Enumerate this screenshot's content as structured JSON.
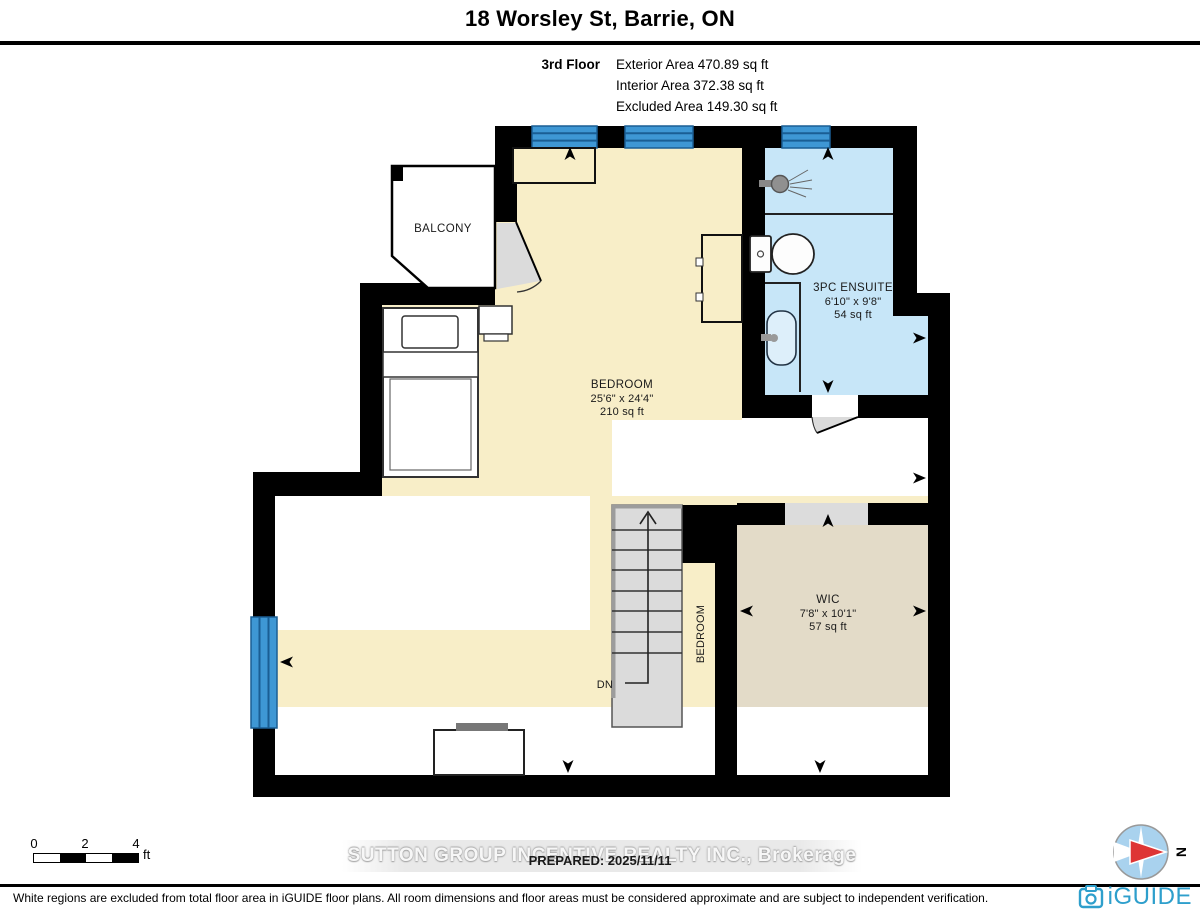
{
  "header": {
    "title": "18 Worsley St, Barrie, ON",
    "floor_label": "3rd Floor",
    "stats": [
      "Exterior Area 470.89 sq ft",
      "Interior Area 372.38 sq ft",
      "Excluded Area 149.30 sq ft"
    ]
  },
  "rooms": {
    "balcony": {
      "name": "BALCONY"
    },
    "bedroom": {
      "name": "BEDROOM",
      "dims": "25'6\" x 24'4\"",
      "area": "210 sq ft"
    },
    "ensuite": {
      "name": "3PC ENSUITE",
      "dims": "6'10\" x 9'8\"",
      "area": "54 sq ft"
    },
    "wic": {
      "name": "WIC",
      "dims": "7'8\" x 10'1\"",
      "area": "57 sq ft"
    },
    "corridor_label": "BEDROOM",
    "stairs_down_label": "DN"
  },
  "scale_bar": {
    "ticks": [
      "0",
      "2",
      "4"
    ],
    "unit": "ft"
  },
  "watermark": {
    "text": "SUTTON GROUP INCENTIVE REALTY INC., Brokerage",
    "prepared": "PREPARED: 2025/11/11"
  },
  "compass": {
    "north_label": "N"
  },
  "footer": {
    "disclaimer": "White regions are excluded from total floor area in iGUIDE floor plans. All room dimensions and floor areas must be considered approximate and are subject to independent verification.",
    "brand": "iGUIDE"
  },
  "colors": {
    "room_fill": "#F8EEC8",
    "wic_fill": "#E3DBC8",
    "ensuite_fill": "#C7E6F8",
    "window_fill": "#3E97D4",
    "wall": "#000000",
    "excluded": "#FFFFFF",
    "stairs": "#DBDBDB",
    "brand_blue": "#2E9FCC",
    "compass_red": "#DE3535"
  }
}
